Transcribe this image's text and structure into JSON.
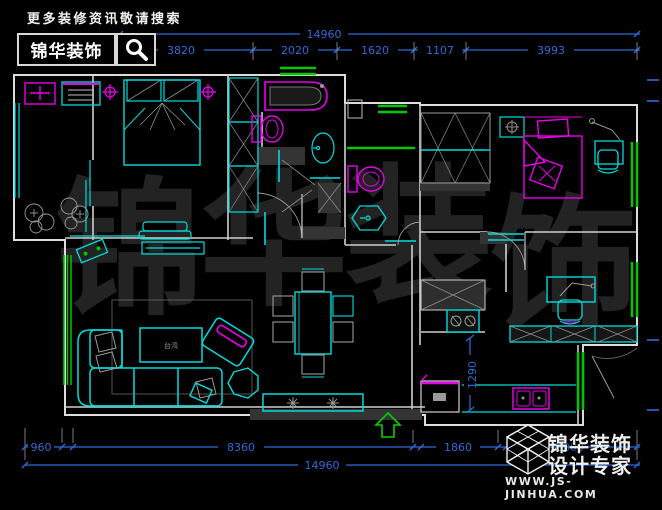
{
  "header": {
    "slogan": "更多装修资讯敬请搜索",
    "brand": "锦华装饰",
    "search_icon": "magnifier-icon"
  },
  "watermark": {
    "chars": [
      "锦",
      "华",
      "装",
      "饰"
    ]
  },
  "dimensions": {
    "top": {
      "overall": "14960",
      "segments": [
        "3820",
        "2020",
        "1620",
        "1107",
        "3993"
      ]
    },
    "bottom": {
      "overall": "14960",
      "segments": [
        "960",
        "8360",
        "1860",
        "3000"
      ]
    },
    "vertical": {
      "kitchen_passage": "1290"
    }
  },
  "plan": {
    "coffee_table_label": "台湾",
    "entry_arrow": "up",
    "colors": {
      "furniture": "#00dcdc",
      "fixtures": "#e800e8",
      "windows": "#00c800",
      "dimensions": "#2f6bd8",
      "walls": "#dcdcdc"
    }
  },
  "footer": {
    "logo_icon": "cube-logo-icon",
    "brand_line1": "锦华装饰",
    "brand_line2": "设计专家",
    "website": "WWW.JS-JINHUA.COM"
  }
}
